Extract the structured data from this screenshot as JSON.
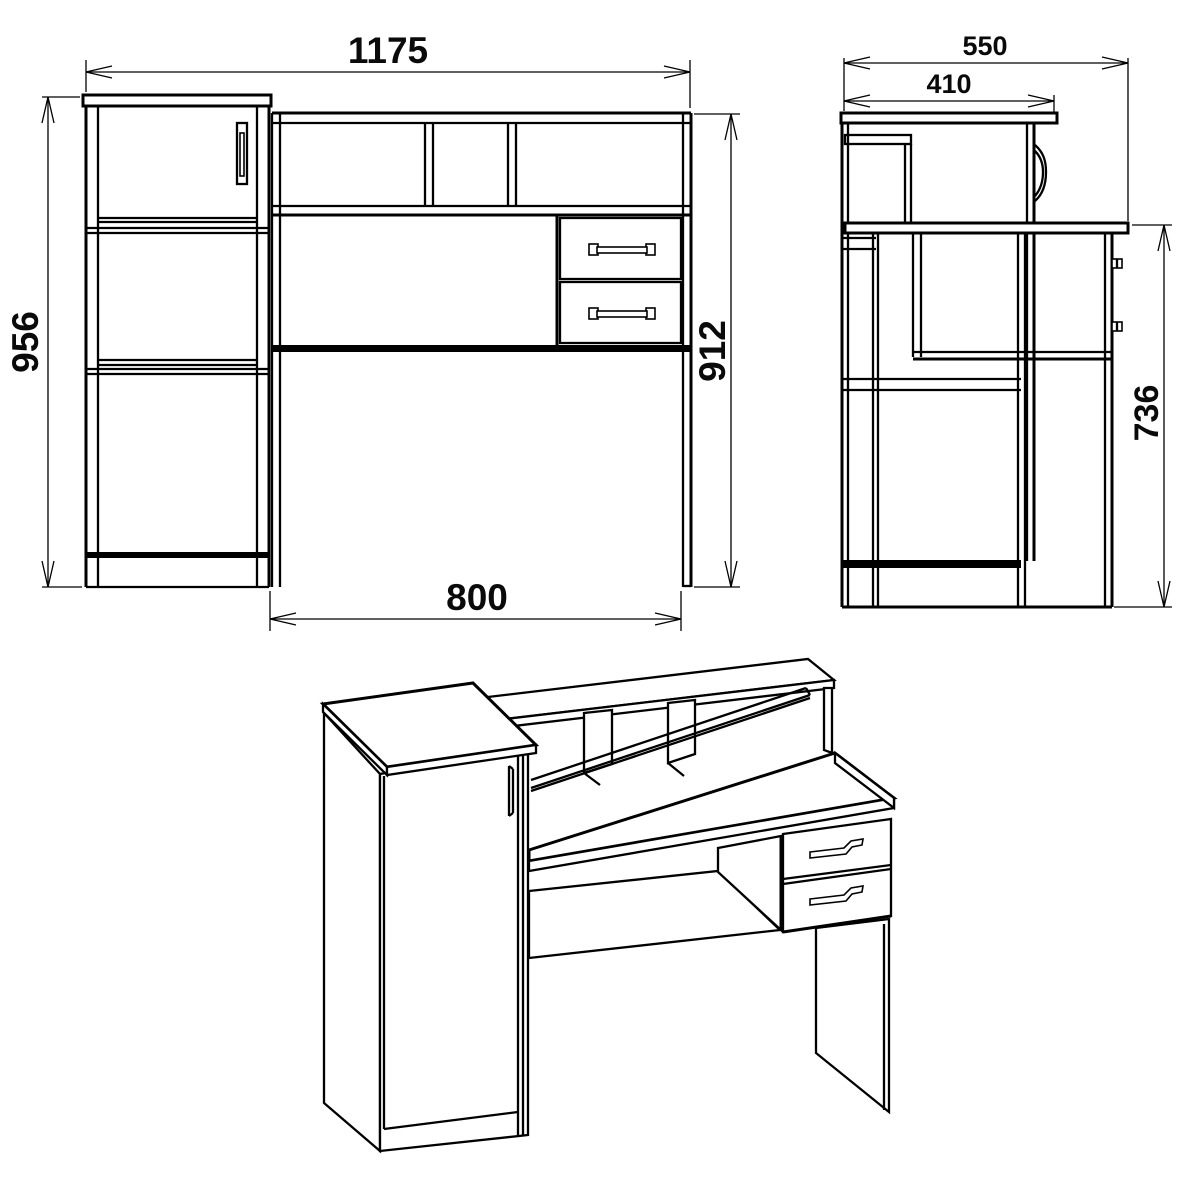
{
  "drawing": {
    "kind": "furniture-technical-drawing",
    "background": "#ffffff",
    "line_color": "#000000"
  },
  "views": {
    "front": {
      "name": "front-view",
      "dims": {
        "total_width": "1175",
        "left_cabinet_height": "956",
        "desk_height": "912",
        "desk_width": "800"
      }
    },
    "side": {
      "name": "side-view",
      "dims": {
        "total_depth": "550",
        "cabinet_depth": "410",
        "desktop_height": "736"
      }
    },
    "iso": {
      "name": "isometric-view"
    }
  }
}
